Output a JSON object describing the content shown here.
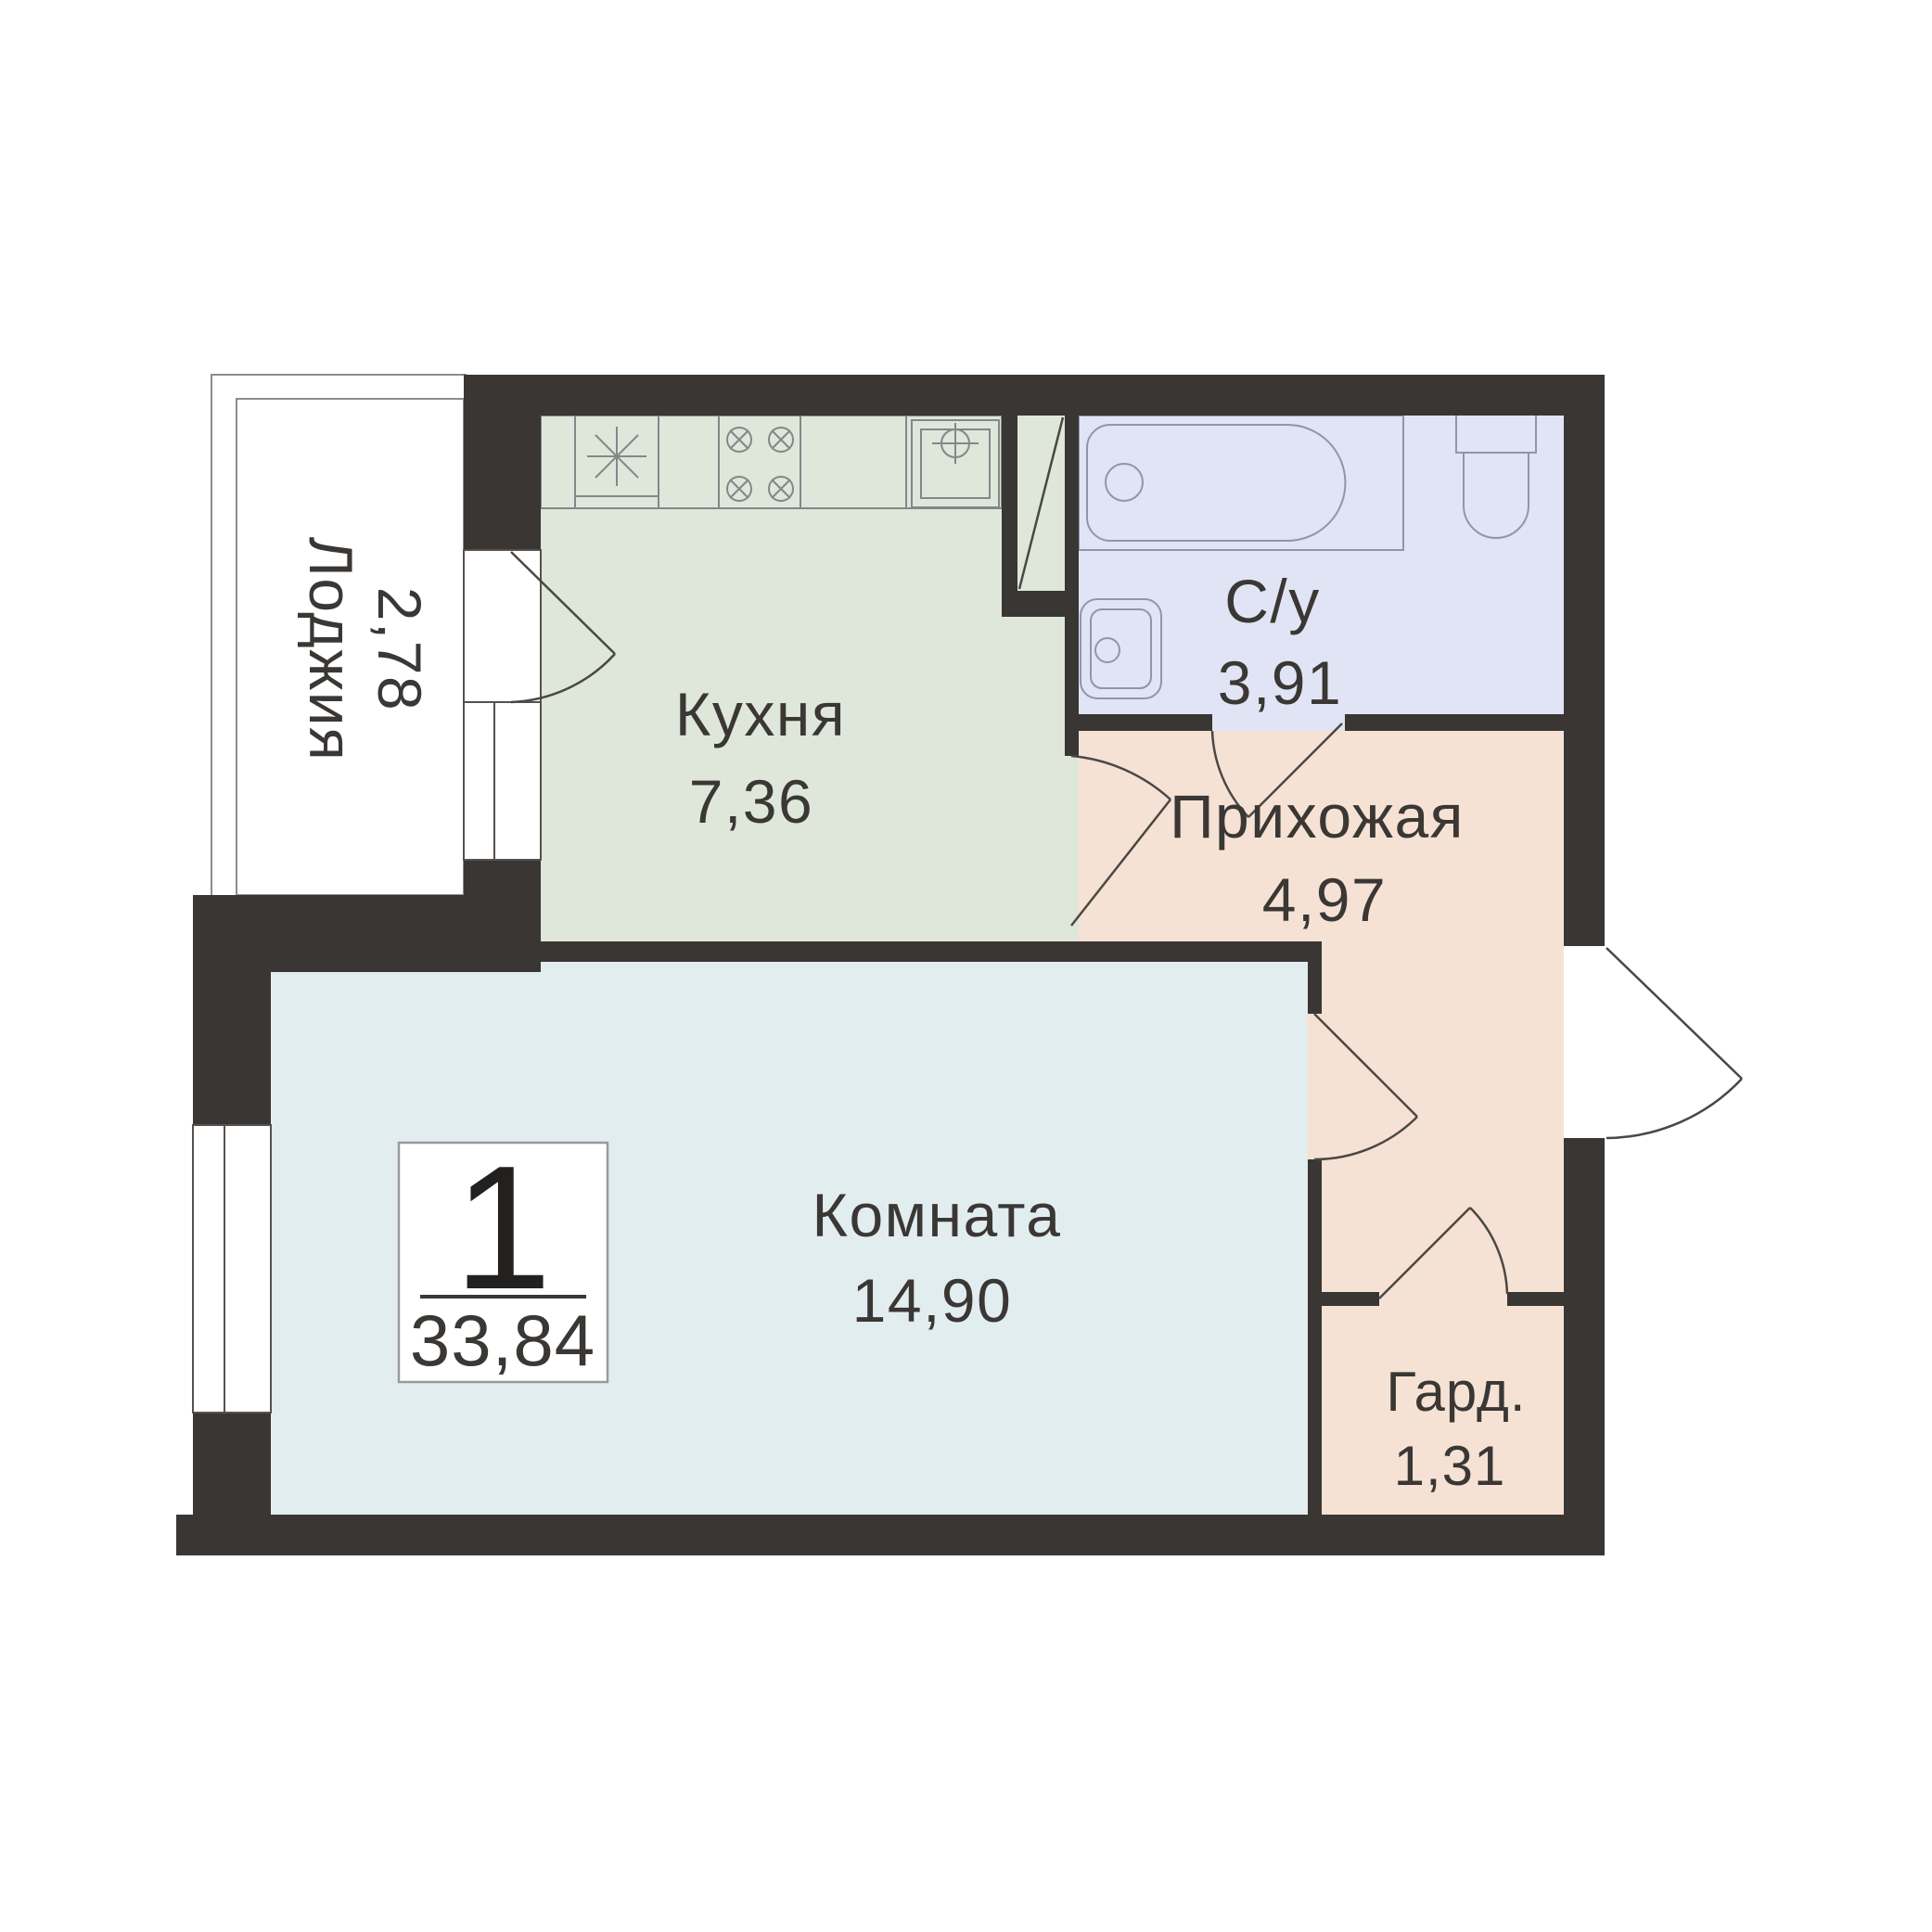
{
  "plan": {
    "title": "1-room apartment floor plan",
    "unit_badge": {
      "rooms": "1",
      "total_area": "33,84"
    },
    "rooms": {
      "loggia": {
        "name": "Лоджия",
        "area": "2,78"
      },
      "kitchen": {
        "name": "Кухня",
        "area": "7,36"
      },
      "bathroom": {
        "name": "С/у",
        "area": "3,91"
      },
      "hallway": {
        "name": "Прихожая",
        "area": "4,97"
      },
      "room": {
        "name": "Комната",
        "area": "14,90"
      },
      "wardrobe": {
        "name": "Гард.",
        "area": "1,31"
      }
    },
    "icons": {
      "fridge": "fridge-icon",
      "stove": "stove-burners-icon",
      "kitchen_sink": "kitchen-sink-icon",
      "bathtub": "bathtub-icon",
      "toilet": "toilet-icon",
      "bath_sink": "washbasin-icon",
      "vent_duct": "vent-duct-icon",
      "doors": "door-swing-icon",
      "windows": "window-icon"
    },
    "colors": {
      "background": "#ffffff",
      "wall": "#3a3633",
      "loggia": "#f5e2d4",
      "kitchen": "#dee7da",
      "bathroom": "#e0e4f4",
      "hallway": "#f5e2d4",
      "room": "#e2edef",
      "wardrobe": "#f5e2d4",
      "lines": "#8d8d8d",
      "text": "#3a3734"
    }
  }
}
